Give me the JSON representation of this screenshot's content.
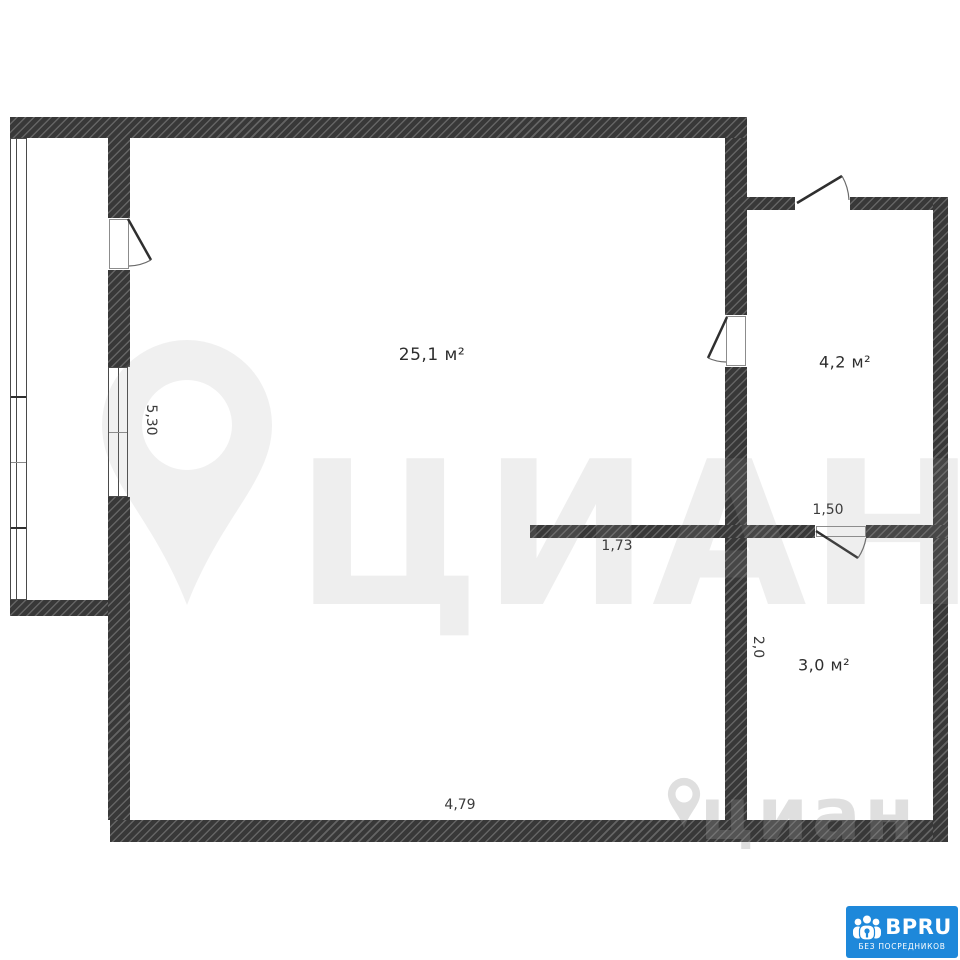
{
  "plan_title": "apartment-floor-plan",
  "rooms": {
    "room_large": {
      "area_label": "25,1 м²"
    },
    "room_small_top": {
      "area_label": "4,2 м²"
    },
    "room_small_bottom": {
      "area_label": "3,0 м²"
    }
  },
  "dimensions": {
    "main_height": "5,30",
    "right_width": "1,50",
    "partition": "1,73",
    "bottom_height": "2,0",
    "main_width": "4,79"
  },
  "watermark": {
    "large_text": "ЦИАН",
    "small_text": "циан"
  },
  "brand_badge": {
    "name": "BPRU",
    "tagline": "БЕЗ ПОСРЕДНИКОВ",
    "background_color": "#1e88da"
  },
  "colors": {
    "wall_dark": "#383838",
    "wall_hatch": "#646464",
    "line": "#4a4a4a",
    "label_text": "#2d2d2d"
  }
}
